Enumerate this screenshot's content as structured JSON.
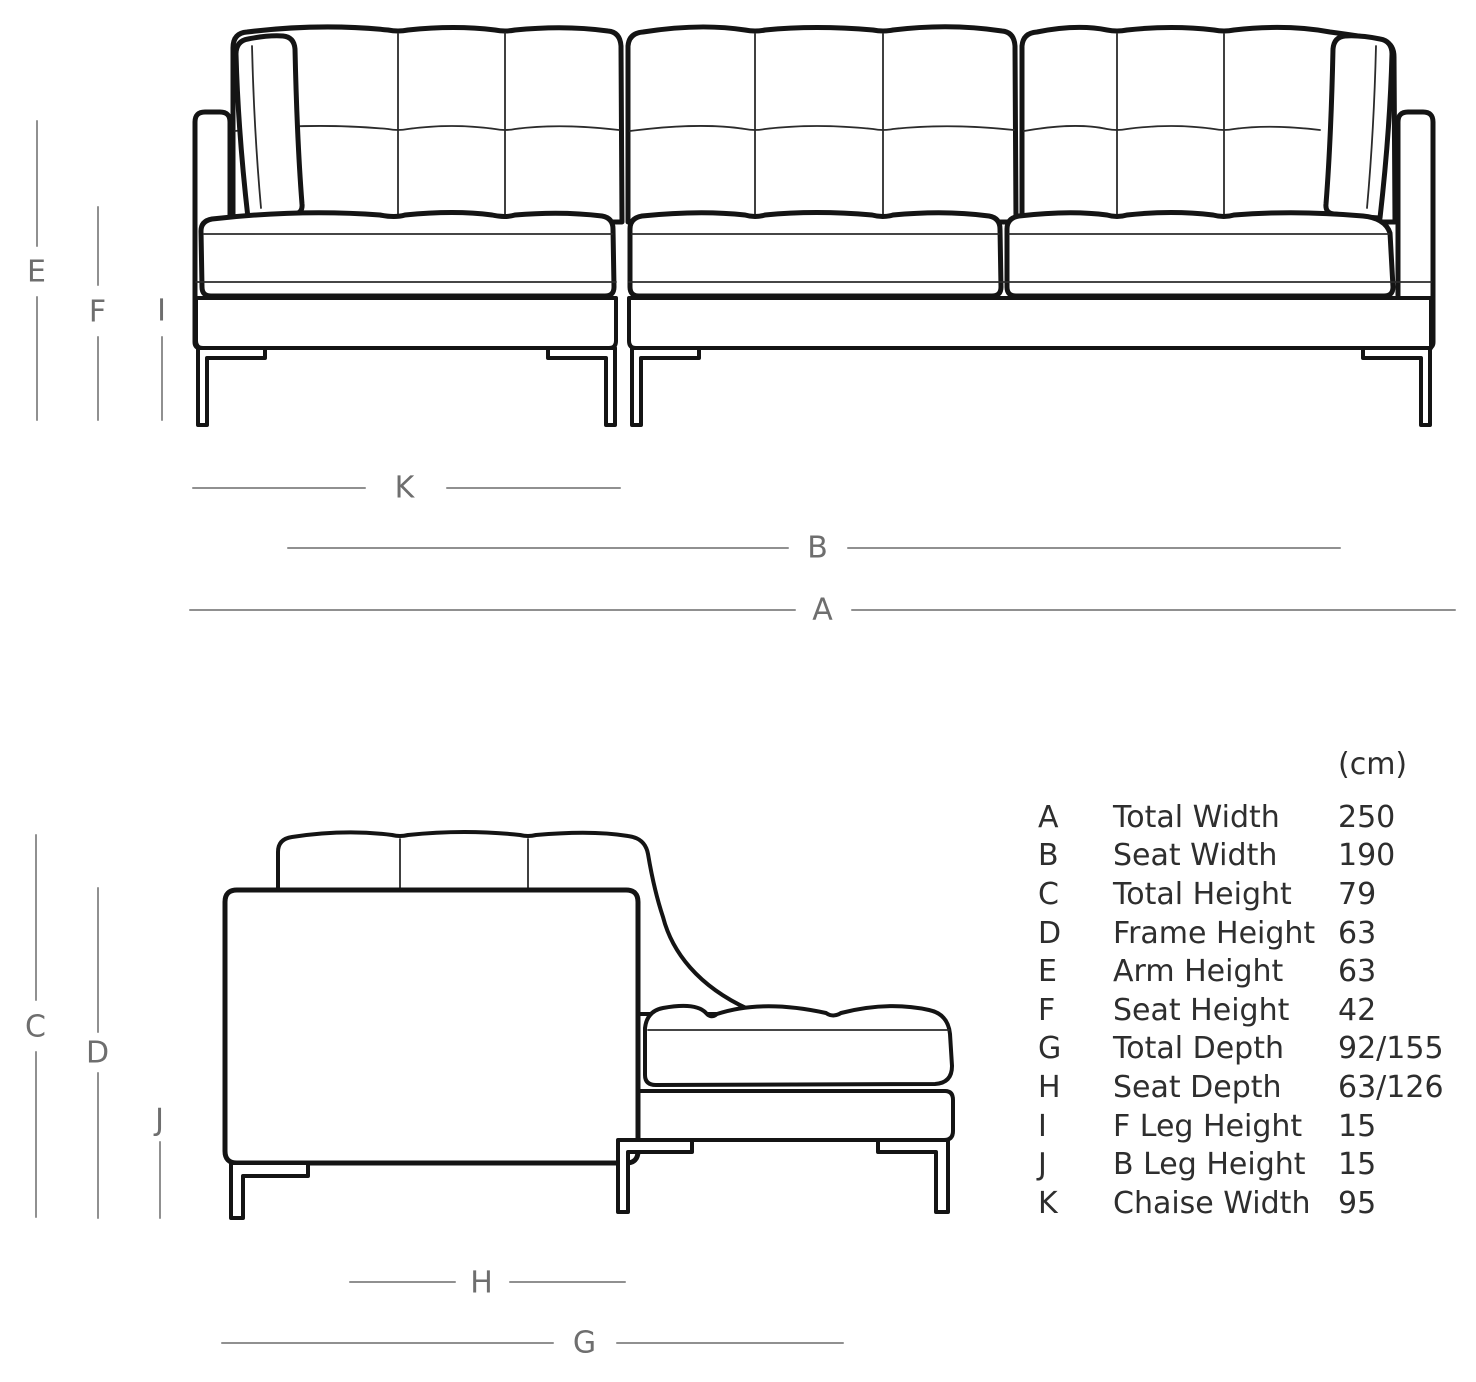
{
  "front_view": {
    "dim_labels": {
      "E": "E",
      "F": "F",
      "I": "I",
      "K": "K",
      "B": "B",
      "A": "A"
    }
  },
  "side_view": {
    "dim_labels": {
      "C": "C",
      "D": "D",
      "J": "J",
      "H": "H",
      "G": "G"
    }
  },
  "legend": {
    "unit_header": "(cm)",
    "rows": [
      {
        "letter": "A",
        "name": "Total Width",
        "value": "250"
      },
      {
        "letter": "B",
        "name": "Seat Width",
        "value": "190"
      },
      {
        "letter": "C",
        "name": "Total Height",
        "value": "79"
      },
      {
        "letter": "D",
        "name": "Frame Height",
        "value": "63"
      },
      {
        "letter": "E",
        "name": "Arm Height",
        "value": "63"
      },
      {
        "letter": "F",
        "name": "Seat Height",
        "value": "42"
      },
      {
        "letter": "G",
        "name": "Total Depth",
        "value": "92/155"
      },
      {
        "letter": "H",
        "name": "Seat Depth",
        "value": "63/126"
      },
      {
        "letter": "I",
        "name": "F Leg Height",
        "value": "15"
      },
      {
        "letter": "J",
        "name": "B Leg Height",
        "value": "15"
      },
      {
        "letter": "K",
        "name": "Chaise Width",
        "value": "95"
      }
    ]
  },
  "colors": {
    "line_art": "#141414",
    "dimension_line": "#909090",
    "dimension_label": "#6e6e6e",
    "legend_text": "#2e2e2e",
    "background": "#ffffff"
  }
}
